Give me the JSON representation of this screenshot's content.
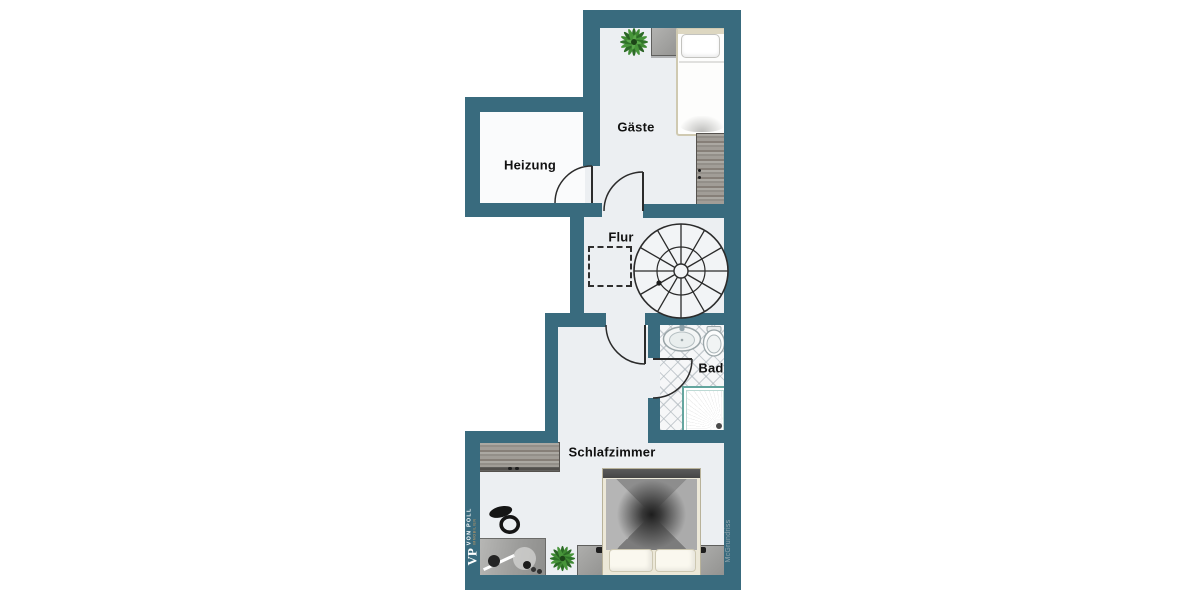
{
  "branding": {
    "monogram": "VP",
    "name": "VON POLL",
    "subtitle": "IMMOBILIEN",
    "watermark": "McGrundriss"
  },
  "rooms": [
    {
      "name": "gaeste",
      "label": "Gäste"
    },
    {
      "name": "heizung",
      "label": "Heizung"
    },
    {
      "name": "flur",
      "label": "Flur"
    },
    {
      "name": "bad",
      "label": "Bad"
    },
    {
      "name": "schlafzimmer",
      "label": "Schlafzimmer"
    }
  ],
  "colors": {
    "wall": "#396B7E",
    "floor": "#ECEFF2",
    "floor_light": "#FAFBFC",
    "line": "#2B2B2B",
    "label": "#111111",
    "shower_accent": "#63A59E",
    "plant_green": "#2F7329",
    "brand_text": "#FFFFFF",
    "brand_accent": "#DFA35F",
    "watermark_gray": "#93A7AE"
  }
}
